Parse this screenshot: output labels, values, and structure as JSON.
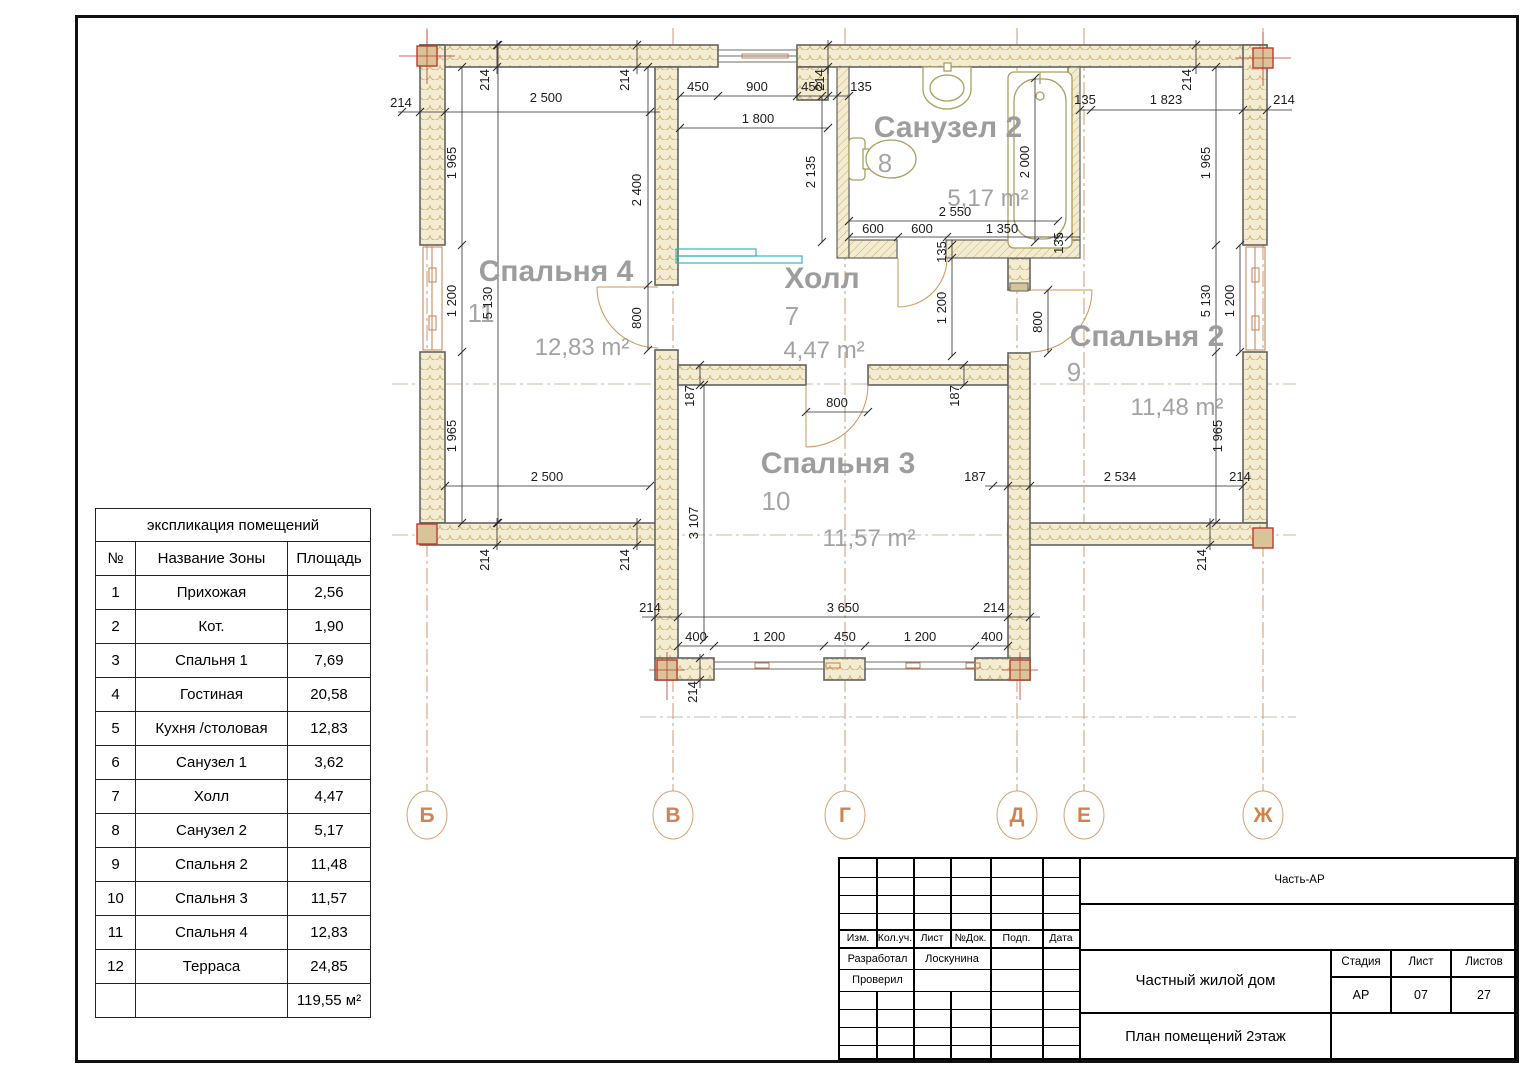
{
  "sheet": {
    "axes": [
      {
        "label": "Б",
        "x": 427
      },
      {
        "label": "В",
        "x": 673
      },
      {
        "label": "Г",
        "x": 845
      },
      {
        "label": "Д",
        "x": 1017
      },
      {
        "label": "Е",
        "x": 1084
      },
      {
        "label": "Ж",
        "x": 1263
      }
    ],
    "axis_row_y": 815
  },
  "rooms": [
    {
      "name": "Спальня 4",
      "number": "11",
      "area": "12,83 m²",
      "nx": 556,
      "ny": 281,
      "numx": 481,
      "numy": 322,
      "ax": 582,
      "ay": 355
    },
    {
      "name": "Холл",
      "number": "7",
      "area": "4,47 m²",
      "nx": 822,
      "ny": 288,
      "numx": 792,
      "numy": 325,
      "ax": 824,
      "ay": 358
    },
    {
      "name": "Санузел 2",
      "number": "8",
      "area": "5,17 m²",
      "nx": 948,
      "ny": 137,
      "numx": 885,
      "numy": 172,
      "ax": 988,
      "ay": 206
    },
    {
      "name": "Спальня 2",
      "number": "9",
      "area": "11,48 m²",
      "nx": 1147,
      "ny": 346,
      "numx": 1074,
      "numy": 381,
      "ax": 1177,
      "ay": 415
    },
    {
      "name": "Спальня 3",
      "number": "10",
      "area": "11,57 m²",
      "nx": 838,
      "ny": 473,
      "numx": 776,
      "numy": 510,
      "ax": 869,
      "ay": 546
    }
  ],
  "dims": [
    {
      "t": "214",
      "x": 401,
      "y": 107,
      "r": 0
    },
    {
      "t": "214",
      "x": 489,
      "y": 80,
      "r": -90
    },
    {
      "t": "2 500",
      "x": 546,
      "y": 102,
      "r": 0
    },
    {
      "t": "214",
      "x": 629,
      "y": 80,
      "r": -90
    },
    {
      "t": "450",
      "x": 698,
      "y": 91,
      "r": 0
    },
    {
      "t": "900",
      "x": 757,
      "y": 91,
      "r": 0
    },
    {
      "t": "450",
      "x": 812,
      "y": 91,
      "r": 0
    },
    {
      "t": "214",
      "x": 824,
      "y": 80,
      "r": -90
    },
    {
      "t": "135",
      "x": 861,
      "y": 91,
      "r": 0
    },
    {
      "t": "1 800",
      "x": 758,
      "y": 123,
      "r": 0
    },
    {
      "t": "2 400",
      "x": 641,
      "y": 190,
      "r": -90
    },
    {
      "t": "2 135",
      "x": 815,
      "y": 172,
      "r": -90
    },
    {
      "t": "135",
      "x": 1085,
      "y": 104,
      "r": 0
    },
    {
      "t": "1 823",
      "x": 1166,
      "y": 104,
      "r": 0
    },
    {
      "t": "214",
      "x": 1191,
      "y": 80,
      "r": -90
    },
    {
      "t": "214",
      "x": 1284,
      "y": 104,
      "r": 0
    },
    {
      "t": "2 000",
      "x": 1029,
      "y": 162,
      "r": -90
    },
    {
      "t": "2 550",
      "x": 955,
      "y": 216,
      "r": 0
    },
    {
      "t": "600",
      "x": 873,
      "y": 233,
      "r": 0
    },
    {
      "t": "600",
      "x": 922,
      "y": 233,
      "r": 0
    },
    {
      "t": "1 350",
      "x": 1002,
      "y": 233,
      "r": 0
    },
    {
      "t": "135",
      "x": 1063,
      "y": 243,
      "r": -90
    },
    {
      "t": "1 965",
      "x": 456,
      "y": 163,
      "r": -90
    },
    {
      "t": "1 200",
      "x": 456,
      "y": 301,
      "r": -90
    },
    {
      "t": "5 130",
      "x": 492,
      "y": 303,
      "r": -90
    },
    {
      "t": "1 965",
      "x": 456,
      "y": 436,
      "r": -90
    },
    {
      "t": "1 965",
      "x": 1210,
      "y": 163,
      "r": -90
    },
    {
      "t": "5 130",
      "x": 1210,
      "y": 301,
      "r": -90
    },
    {
      "t": "1 200",
      "x": 1234,
      "y": 301,
      "r": -90
    },
    {
      "t": "1 965",
      "x": 1222,
      "y": 436,
      "r": -90
    },
    {
      "t": "800",
      "x": 641,
      "y": 318,
      "r": -90
    },
    {
      "t": "187",
      "x": 694,
      "y": 396,
      "r": -90
    },
    {
      "t": "800",
      "x": 837,
      "y": 407,
      "r": 0
    },
    {
      "t": "187",
      "x": 959,
      "y": 396,
      "r": -90
    },
    {
      "t": "135",
      "x": 946,
      "y": 252,
      "r": -90
    },
    {
      "t": "1 200",
      "x": 946,
      "y": 308,
      "r": -90
    },
    {
      "t": "800",
      "x": 1042,
      "y": 322,
      "r": -90
    },
    {
      "t": "2 500",
      "x": 547,
      "y": 481,
      "r": 0
    },
    {
      "t": "187",
      "x": 975,
      "y": 481,
      "r": 0
    },
    {
      "t": "2 534",
      "x": 1120,
      "y": 481,
      "r": 0
    },
    {
      "t": "214",
      "x": 1240,
      "y": 481,
      "r": 0
    },
    {
      "t": "3 107",
      "x": 698,
      "y": 523,
      "r": -90
    },
    {
      "t": "214",
      "x": 489,
      "y": 560,
      "r": -90
    },
    {
      "t": "214",
      "x": 629,
      "y": 560,
      "r": -90
    },
    {
      "t": "214",
      "x": 1206,
      "y": 560,
      "r": -90
    },
    {
      "t": "214",
      "x": 650,
      "y": 612,
      "r": 0
    },
    {
      "t": "3 650",
      "x": 843,
      "y": 612,
      "r": 0
    },
    {
      "t": "214",
      "x": 994,
      "y": 612,
      "r": 0
    },
    {
      "t": "400",
      "x": 696,
      "y": 641,
      "r": 0
    },
    {
      "t": "1 200",
      "x": 769,
      "y": 641,
      "r": 0
    },
    {
      "t": "450",
      "x": 845,
      "y": 641,
      "r": 0
    },
    {
      "t": "1 200",
      "x": 920,
      "y": 641,
      "r": 0
    },
    {
      "t": "400",
      "x": 992,
      "y": 641,
      "r": 0
    },
    {
      "t": "214",
      "x": 697,
      "y": 692,
      "r": -90
    }
  ],
  "table": {
    "title": "экспликация помещений",
    "headers": [
      "№",
      "Название Зоны",
      "Площадь"
    ],
    "rows": [
      [
        "1",
        "Прихожая",
        "2,56"
      ],
      [
        "2",
        "Кот.",
        "1,90"
      ],
      [
        "3",
        "Спальня 1",
        "7,69"
      ],
      [
        "4",
        "Гостиная",
        "20,58"
      ],
      [
        "5",
        "Кухня /столовая",
        "12,83"
      ],
      [
        "6",
        "Санузел 1",
        "3,62"
      ],
      [
        "7",
        "Холл",
        "4,47"
      ],
      [
        "8",
        "Санузел 2",
        "5,17"
      ],
      [
        "9",
        "Спальня 2",
        "11,48"
      ],
      [
        "10",
        "Спальня 3",
        "11,57"
      ],
      [
        "11",
        "Спальня 4",
        "12,83"
      ],
      [
        "12",
        "Терраса",
        "24,85"
      ]
    ],
    "total": "119,55 м²"
  },
  "titleblock": {
    "part": "Часть-АР",
    "columns": [
      "Изм.",
      "Кол.уч.",
      "Лист",
      "№Док.",
      "Подп.",
      "Дата"
    ],
    "developed_label": "Разработал",
    "developed_value": "Лоскунина",
    "checked_label": "Проверил",
    "project": "Частный жилой дом",
    "stage_label": "Стадия",
    "sheet_label": "Лист",
    "sheets_label": "Листов",
    "stage": "АР",
    "sheet_no": "07",
    "sheets_total": "27",
    "drawing": "План помещений 2этаж"
  },
  "colors": {
    "wall_fill": "#f3ecd0",
    "wall_hatch": "#c9ae6e",
    "wall_stroke": "#63625e",
    "axis_orange": "#d2824e",
    "room_gray": "#9d9d9d",
    "column_red": "#c0392b",
    "column_fill": "#d9c49a",
    "stair_cyan": "#35b6b6",
    "fixture_olive": "#ab9e5e"
  }
}
